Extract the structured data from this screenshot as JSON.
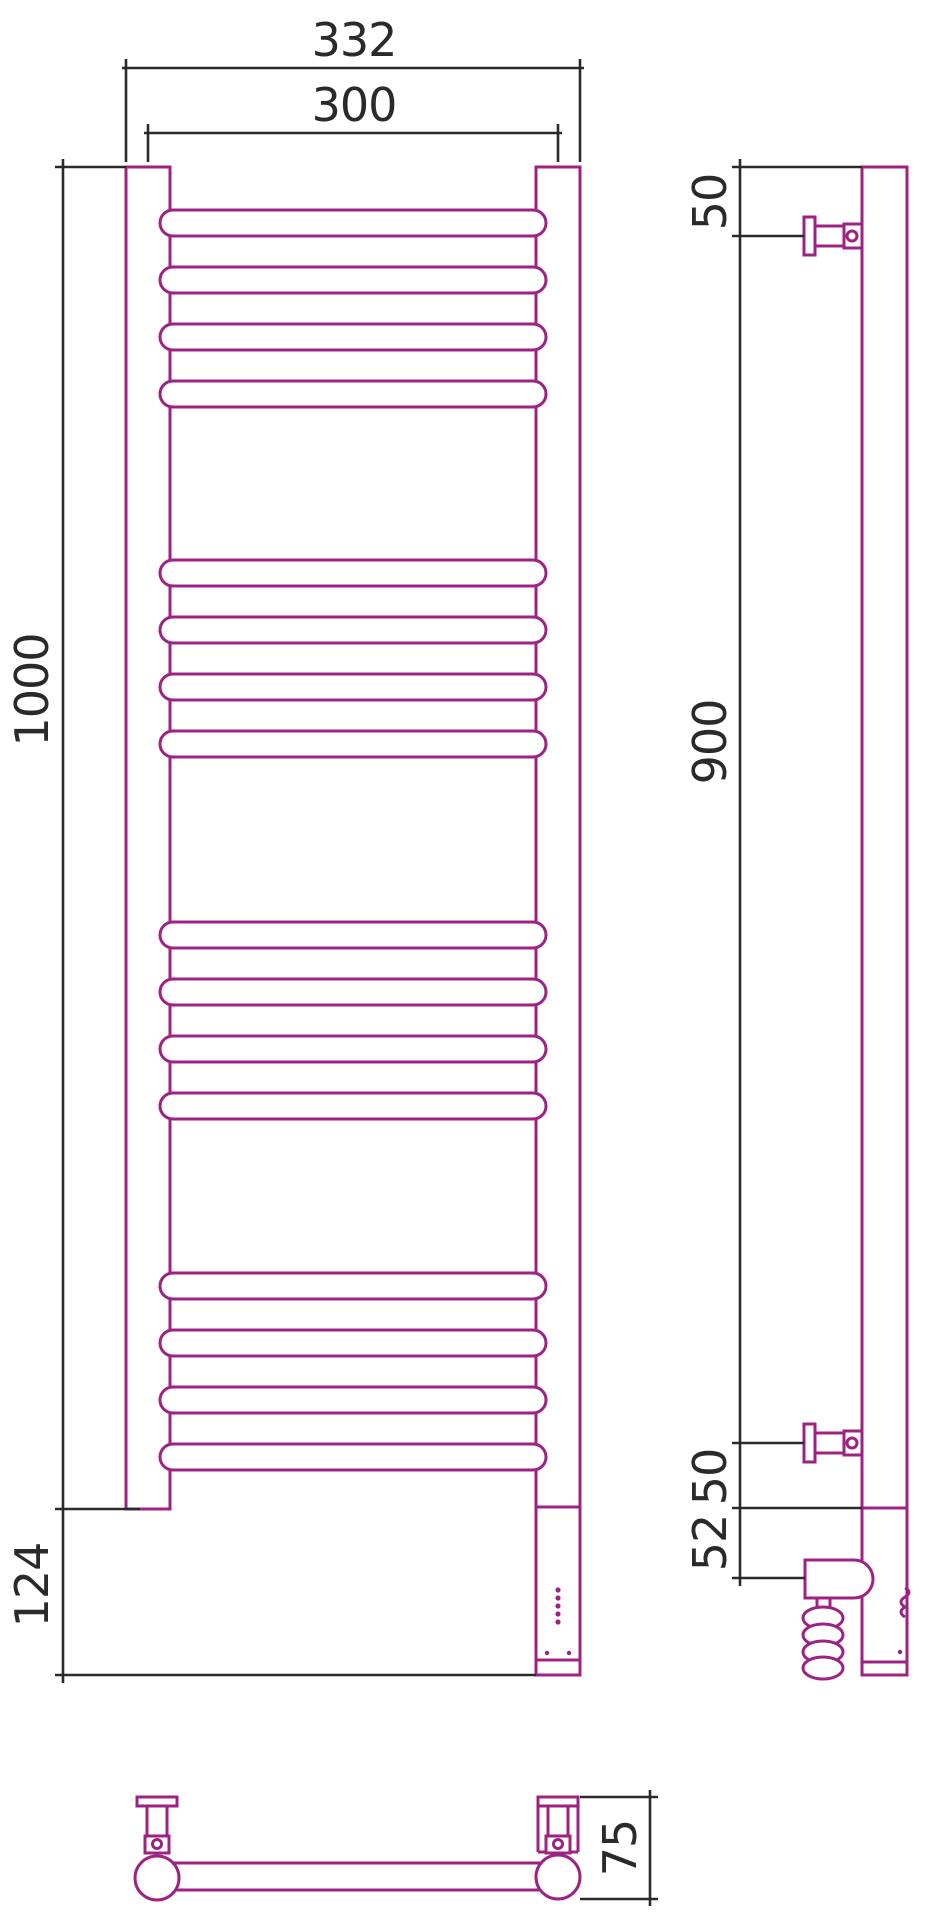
{
  "title": "Heated towel rail — dimensional technical drawing (front, side, bottom views)",
  "colors": {
    "outline": "#9e2282",
    "dimension": "#2a2a2a",
    "background": "#ffffff"
  },
  "front_view": {
    "dim_overall_width": "332",
    "dim_rail_width": "300",
    "dim_height": "1000",
    "dim_bottom_section": "124",
    "rung_groups": 4,
    "rungs_per_group": 4,
    "led_dot_count": 5,
    "bottom_dot_count": 2
  },
  "side_view": {
    "dim_top_bracket": "50",
    "dim_bracket_span": "900",
    "dim_bottom_bracket": "50",
    "dim_heater_axis": "52"
  },
  "bottom_view": {
    "dim_depth": "75"
  }
}
